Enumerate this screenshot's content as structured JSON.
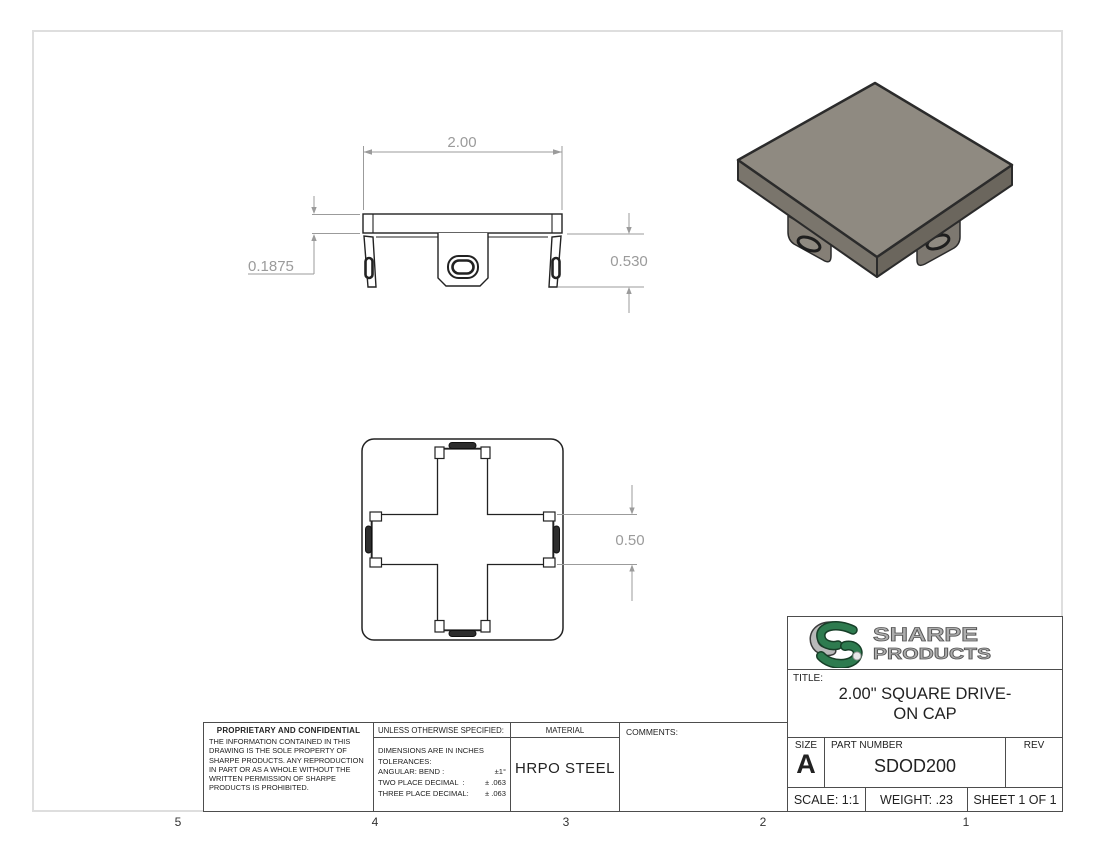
{
  "frame": {
    "zones": [
      "5",
      "4",
      "3",
      "2",
      "1"
    ]
  },
  "views": {
    "front": {
      "dim_width": "2.00",
      "dim_thickness": "0.1875",
      "dim_height": "0.530"
    },
    "bottom": {
      "dim_slot": "0.50"
    }
  },
  "notes": {
    "proprietary": {
      "title": "PROPRIETARY AND CONFIDENTIAL",
      "body": "THE INFORMATION CONTAINED IN THIS DRAWING IS THE SOLE PROPERTY OF SHARPE PRODUCTS.  ANY REPRODUCTION IN PART OR AS A WHOLE WITHOUT THE WRITTEN PERMISSION OF SHARPE PRODUCTS IS PROHIBITED."
    },
    "spec": {
      "header": "UNLESS OTHERWISE SPECIFIED:",
      "rows": [
        {
          "label": "DIMENSIONS ARE IN INCHES",
          "value": ""
        },
        {
          "label": "TOLERANCES:",
          "value": ""
        },
        {
          "label": "ANGULAR: BEND :",
          "value": "±1°"
        },
        {
          "label": "TWO PLACE DECIMAL  :",
          "value": "± .063"
        },
        {
          "label": "THREE PLACE DECIMAL:",
          "value": "± .063"
        }
      ]
    },
    "material": {
      "label": "MATERIAL",
      "value": "HRPO STEEL"
    },
    "comments": {
      "label": "COMMENTS:"
    }
  },
  "title_block": {
    "brand_line1": "SHARPE",
    "brand_line2": "PRODUCTS",
    "title_label": "TITLE:",
    "title_line1": "2.00\" SQUARE DRIVE-",
    "title_line2": "ON CAP",
    "size_label": "SIZE",
    "size_value": "A",
    "part_number_label": "PART NUMBER",
    "part_number_value": "SDOD200",
    "rev_label": "REV",
    "scale": "SCALE: 1:1",
    "weight": "WEIGHT: .23",
    "sheet": "SHEET 1 OF 1"
  },
  "colors": {
    "brand_green": "#2E7B4F",
    "logo_silver": "#ADADAD",
    "dim_gray": "#9B9B9B",
    "line_dark": "#222222",
    "cap_top": "#8F8A81",
    "cap_side_left": "#7A756C",
    "cap_side_right": "#6B665D",
    "sheet_border": "#DEDEDE"
  }
}
